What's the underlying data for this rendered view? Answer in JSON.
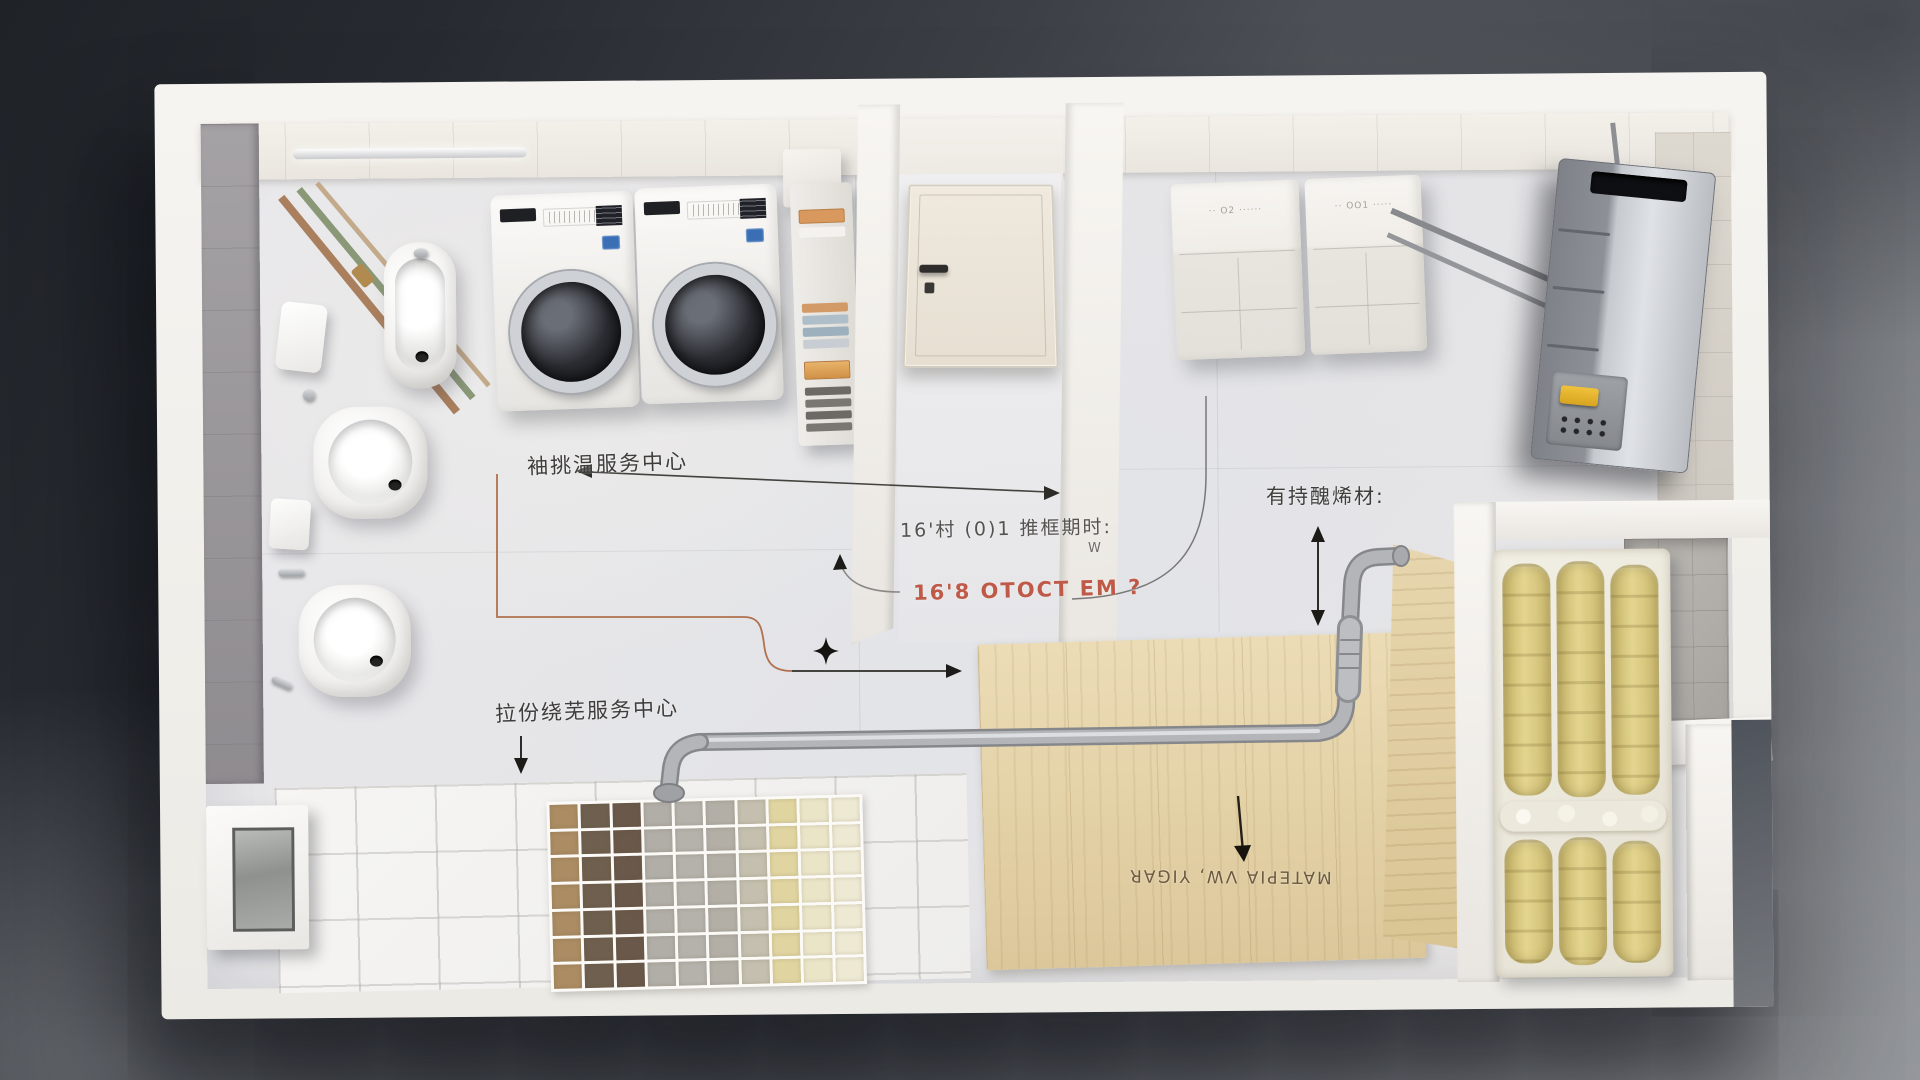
{
  "annotations": {
    "service_center_top": "袖挑温服务中心",
    "dim_note": "16'村 (0)1 推框期时:",
    "w_label": "W",
    "red_note": "16'8 OTOCT EM   ?",
    "material_note": "有持醜烯材:",
    "service_center_bottom": "拉份绕芜服务中心",
    "wood_stamp": "MATEPIA VW, YIGAR"
  },
  "appliances": {
    "cabinet_left_label": "·· O2 ······",
    "cabinet_right_label": "·· OO1 ·····"
  },
  "tile_samples": {
    "rows": 7,
    "columns": 10,
    "column_colors": [
      "#ab8c63",
      "#6f5f4e",
      "#6a594a",
      "#b1aea7",
      "#b5b2ab",
      "#b3afa6",
      "#c4bfae",
      "#e0d5a0",
      "#ebe5c8",
      "#eee9d3"
    ]
  },
  "colors": {
    "background_dark": "#1f2328",
    "background_light": "#94979b",
    "wall_white": "#f2efe9",
    "floor_gray": "#e6e5e7",
    "grey_wall": "#9a979a",
    "wood": "#e3d1a6",
    "insulation_yellow": "#d8c87e",
    "wool_white": "#f0ede1",
    "pipe_gray": "#b3b5b9",
    "annotation_dark": "#3f3d3b",
    "annotation_orange": "#b0714e",
    "annotation_red": "#bf5a49",
    "washer_badge_blue": "#3a6fb5",
    "boiler_button_yellow": "#e4b42e"
  }
}
